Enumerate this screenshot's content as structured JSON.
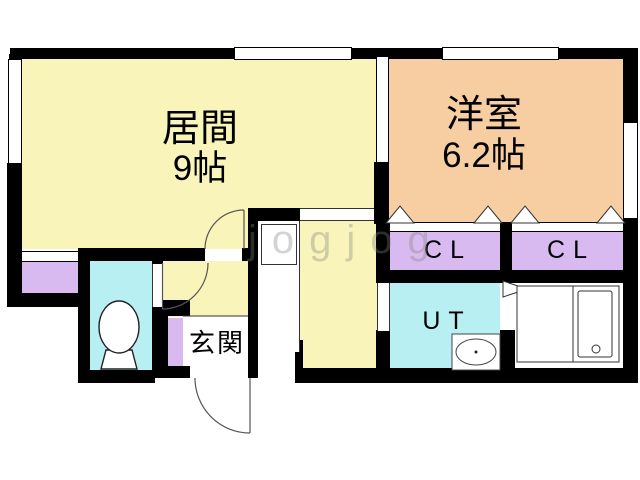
{
  "floorplan": {
    "type": "japanese-apartment-floor-plan",
    "rooms": {
      "living": {
        "name": "居間",
        "size": "9帖",
        "color": "#F8F4BA"
      },
      "western_room": {
        "name": "洋室",
        "size": "6.2帖",
        "color": "#F6CEA2"
      },
      "closet_left": {
        "name": "CL",
        "color": "#D9BAF0"
      },
      "closet_right": {
        "name": "CL",
        "color": "#D9BAF0"
      },
      "utility": {
        "name": "UT",
        "color": "#B7EFF2"
      },
      "entrance": {
        "name": "玄関",
        "color": "#FFFFFF"
      },
      "toilet": {
        "name": "",
        "color": "#B7EFF2"
      },
      "closet_bottom_left": {
        "name": "",
        "color": "#D9BAF0"
      },
      "shoe_box": {
        "name": "",
        "color": "#D9BAF0"
      },
      "bathroom": {
        "name": "",
        "color": "#FFFFFF"
      }
    },
    "fixtures": [
      "toilet-icon",
      "washbasin-icon",
      "bathtub-icon"
    ],
    "wall_color": "#000000",
    "door_arc_color": "#555555",
    "watermark": "jogjog"
  }
}
